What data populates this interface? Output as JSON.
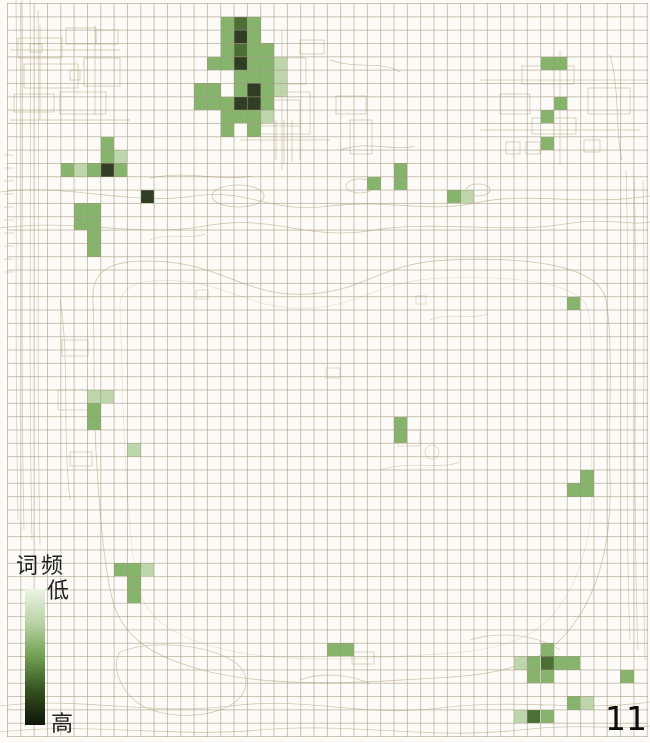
{
  "page": {
    "number": "11"
  },
  "legend": {
    "title": "词频",
    "low_label": "低",
    "high_label": "高",
    "gradient_stops": [
      "#ecf3e5",
      "#b9d3a4",
      "#6f9e51",
      "#33511d",
      "#0f140a"
    ]
  },
  "grid": {
    "origin_x": 7.3,
    "origin_y": 3.3,
    "cell_size": 13.33,
    "cols": 48,
    "rows": 55,
    "line_color": "#a0967f8f"
  },
  "chart_data": {
    "type": "heatmap",
    "title": "词频 (word frequency) grid heatmap over a site-plan map",
    "legend": {
      "title": "词频",
      "low": "低",
      "high": "高"
    },
    "intensity_scale": "1=low(light green) to 4=high(near black)",
    "intensity_levels": {
      "1": "#b9d2a4",
      "2": "#7dae5f",
      "3": "#3c6323",
      "4": "#1f2c11"
    },
    "cells": [
      [
        16,
        1,
        2
      ],
      [
        17,
        1,
        3
      ],
      [
        18,
        1,
        2
      ],
      [
        16,
        2,
        2
      ],
      [
        17,
        2,
        4
      ],
      [
        18,
        2,
        2
      ],
      [
        16,
        3,
        2
      ],
      [
        17,
        3,
        3
      ],
      [
        18,
        3,
        2
      ],
      [
        19,
        3,
        2
      ],
      [
        15,
        4,
        2
      ],
      [
        16,
        4,
        2
      ],
      [
        17,
        4,
        4
      ],
      [
        18,
        4,
        2
      ],
      [
        19,
        4,
        2
      ],
      [
        20,
        4,
        1
      ],
      [
        17,
        5,
        2
      ],
      [
        18,
        5,
        2
      ],
      [
        19,
        5,
        2
      ],
      [
        20,
        5,
        1
      ],
      [
        14,
        6,
        2
      ],
      [
        15,
        6,
        2
      ],
      [
        17,
        6,
        2
      ],
      [
        18,
        6,
        4
      ],
      [
        19,
        6,
        2
      ],
      [
        20,
        6,
        1
      ],
      [
        14,
        7,
        2
      ],
      [
        15,
        7,
        2
      ],
      [
        16,
        7,
        2
      ],
      [
        17,
        7,
        4
      ],
      [
        18,
        7,
        4
      ],
      [
        19,
        7,
        2
      ],
      [
        16,
        8,
        2
      ],
      [
        17,
        8,
        2
      ],
      [
        18,
        8,
        2
      ],
      [
        19,
        8,
        1
      ],
      [
        16,
        9,
        2
      ],
      [
        18,
        9,
        2
      ],
      [
        40,
        4,
        2
      ],
      [
        41,
        4,
        2
      ],
      [
        41,
        7,
        2
      ],
      [
        40,
        8,
        2
      ],
      [
        40,
        10,
        2
      ],
      [
        7,
        10,
        2
      ],
      [
        7,
        11,
        2
      ],
      [
        8,
        11,
        1
      ],
      [
        4,
        12,
        2
      ],
      [
        5,
        12,
        1
      ],
      [
        6,
        12,
        2
      ],
      [
        7,
        12,
        4
      ],
      [
        8,
        12,
        2
      ],
      [
        10,
        14,
        4
      ],
      [
        5,
        15,
        2
      ],
      [
        6,
        15,
        2
      ],
      [
        5,
        16,
        2
      ],
      [
        6,
        16,
        2
      ],
      [
        6,
        17,
        2
      ],
      [
        6,
        18,
        2
      ],
      [
        29,
        12,
        2
      ],
      [
        27,
        13,
        2
      ],
      [
        29,
        13,
        2
      ],
      [
        33,
        14,
        2
      ],
      [
        34,
        14,
        1
      ],
      [
        42,
        22,
        2
      ],
      [
        6,
        29,
        1
      ],
      [
        7,
        29,
        1
      ],
      [
        6,
        30,
        2
      ],
      [
        6,
        31,
        2
      ],
      [
        9,
        33,
        1
      ],
      [
        29,
        31,
        2
      ],
      [
        29,
        32,
        2
      ],
      [
        43,
        35,
        2
      ],
      [
        42,
        36,
        2
      ],
      [
        43,
        36,
        2
      ],
      [
        8,
        42,
        2
      ],
      [
        9,
        42,
        2
      ],
      [
        10,
        42,
        1
      ],
      [
        9,
        43,
        2
      ],
      [
        9,
        44,
        2
      ],
      [
        24,
        48,
        2
      ],
      [
        25,
        48,
        2
      ],
      [
        40,
        48,
        2
      ],
      [
        38,
        49,
        1
      ],
      [
        39,
        49,
        2
      ],
      [
        40,
        49,
        3
      ],
      [
        41,
        49,
        2
      ],
      [
        42,
        49,
        2
      ],
      [
        39,
        50,
        2
      ],
      [
        40,
        50,
        2
      ],
      [
        46,
        50,
        2
      ],
      [
        42,
        52,
        2
      ],
      [
        43,
        52,
        1
      ],
      [
        38,
        53,
        1
      ],
      [
        39,
        53,
        3
      ],
      [
        40,
        53,
        2
      ]
    ]
  }
}
